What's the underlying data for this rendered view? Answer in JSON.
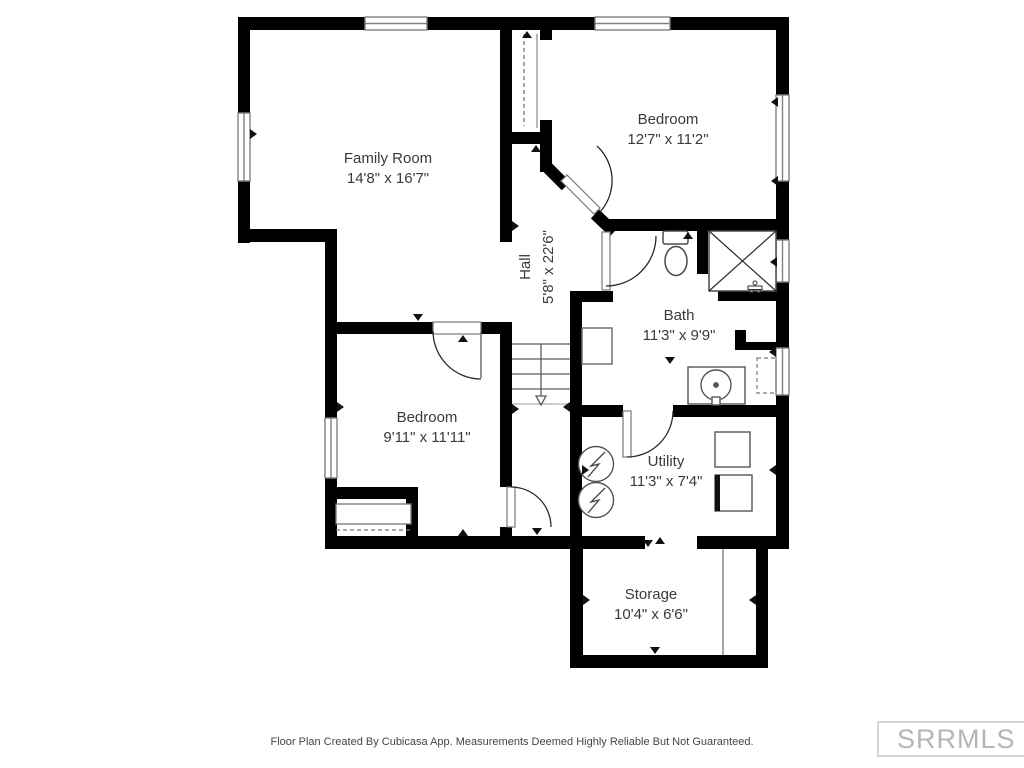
{
  "plan": {
    "rooms": {
      "family_room": {
        "name": "Family Room",
        "dims": "14'8\" x 16'7\""
      },
      "bedroom_upper": {
        "name": "Bedroom",
        "dims": "12'7\" x 11'2\""
      },
      "hall": {
        "name": "Hall",
        "dims": "5'8\" x 22'6\""
      },
      "bath": {
        "name": "Bath",
        "dims": "11'3\" x 9'9\""
      },
      "bedroom_lower": {
        "name": "Bedroom",
        "dims": "9'11\" x 11'11\""
      },
      "utility": {
        "name": "Utility",
        "dims": "11'3\" x 7'4\""
      },
      "storage": {
        "name": "Storage",
        "dims": "10'4\" x 6'6\""
      }
    },
    "footer_disclaimer": "Floor Plan Created By Cubicasa App. Measurements Deemed Highly Reliable But Not Guaranteed.",
    "watermark": "SRRMLS",
    "colors": {
      "wall": "#000000",
      "background": "#ffffff",
      "label_text": "#3a3a3a",
      "fixture_outline": "#555555",
      "footer_text": "#454545",
      "watermark_text": "#b5b5b5",
      "watermark_border": "#d4d4d4"
    }
  }
}
